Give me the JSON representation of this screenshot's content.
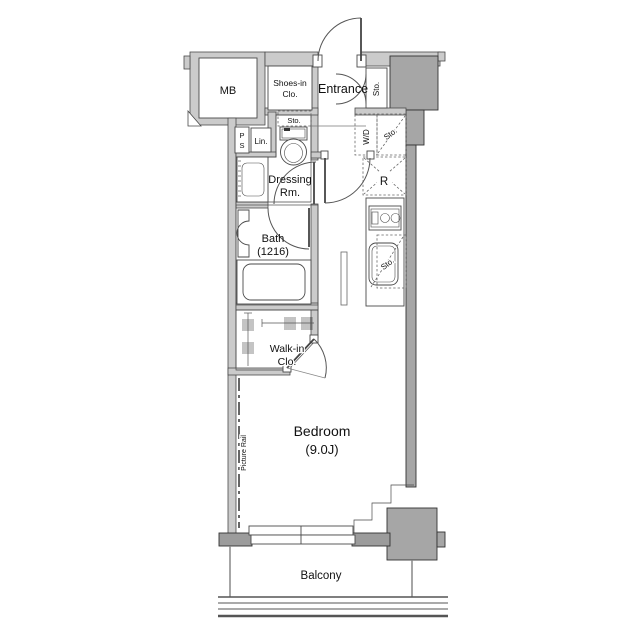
{
  "plan_type": "apartment-floorplan",
  "colors": {
    "bg": "#ffffff",
    "wall": "#cbcbcb",
    "pillar": "#a6a6a6",
    "darkwall": "#9c9c9c",
    "wallline": "#4a4a4a"
  },
  "labels": {
    "mb": "MB",
    "shoes1": "Shoes-in",
    "shoes2": "Clo.",
    "entrance": "Entrance",
    "sto_entrance": "Sto.",
    "ps_p": "P",
    "ps_s": "S",
    "lin": "Lin.",
    "sto_toilet": "Sto.",
    "dressing1": "Dressing",
    "dressing2": "Rm.",
    "wd": "W/D",
    "sto_hall": "Sto.",
    "fridge": "R",
    "bath1": "Bath",
    "bath2": "(1216)",
    "sto_kitchen": "Sto.",
    "walkin1": "Walk-in",
    "walkin2": "Clo.",
    "bedroom1": "Bedroom",
    "bedroom2": "(9.0J)",
    "picture_rail": "Picture Rail",
    "balcony": "Balcony"
  }
}
